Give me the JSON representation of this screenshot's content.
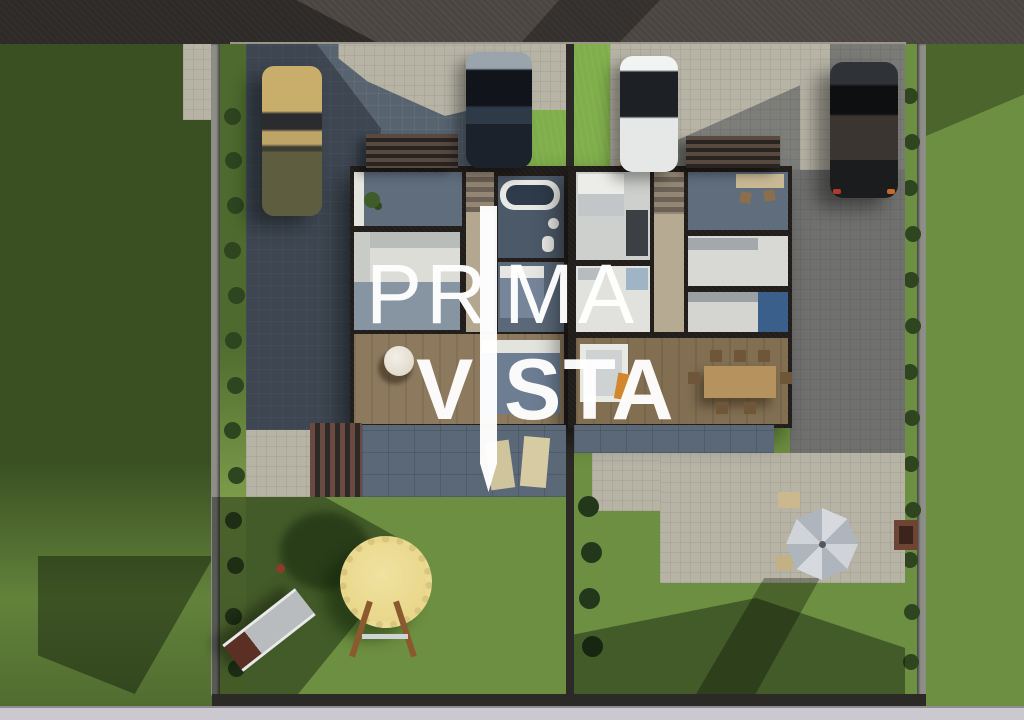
{
  "watermark": {
    "brand": "PRIMA VISTA",
    "line1_left": "PR",
    "line1_right": "MA",
    "line2_left": "V",
    "line2_right": "STA",
    "color": "#ffffff"
  },
  "palette": {
    "grass-bright": "#6d8f41",
    "grass-strip": "#7fae4b",
    "grass-dark": "#3f5a28",
    "road-top": "#4b4541",
    "road-bottom": "#cbc9cf",
    "fence-gray": "#8e8e89",
    "fence-dark": "#2c2a27",
    "paver-blue": "#57636f",
    "paver-light": "#b7b4a6",
    "paver-pale": "#bcbfb5",
    "wall": "#211d1a",
    "wood": "#8d7a5e",
    "terrace": "#5b6877",
    "white-floor": "#dcddd7",
    "blue-floor": "#4c5968",
    "kitchen-blue": "#3a5f8a",
    "accent-orange": "#d2872f",
    "trampoline": "#e9d88c",
    "trampoline-edge": "#d9c67e",
    "umbrella-light": "#d6dadf",
    "umbrella-dark": "#aeb5bd",
    "car-tan": "#c8ad6b",
    "car-olive": "#5f5d40",
    "car-navy": "#1b222c",
    "car-white": "#e6e8e8",
    "car-black": "#1b1c1e",
    "bush": "#2e4520"
  },
  "scene_objects": [
    "street at top and bottom",
    "two semi-detached houses shown as top-down floor plan",
    "four parked cars on driveways",
    "block-paved driveways and patios",
    "terraces with sun loungers",
    "louvered pergola",
    "trampoline with slide and ladder",
    "parasol over garden table",
    "lawns, hedges and boundary fences"
  ]
}
